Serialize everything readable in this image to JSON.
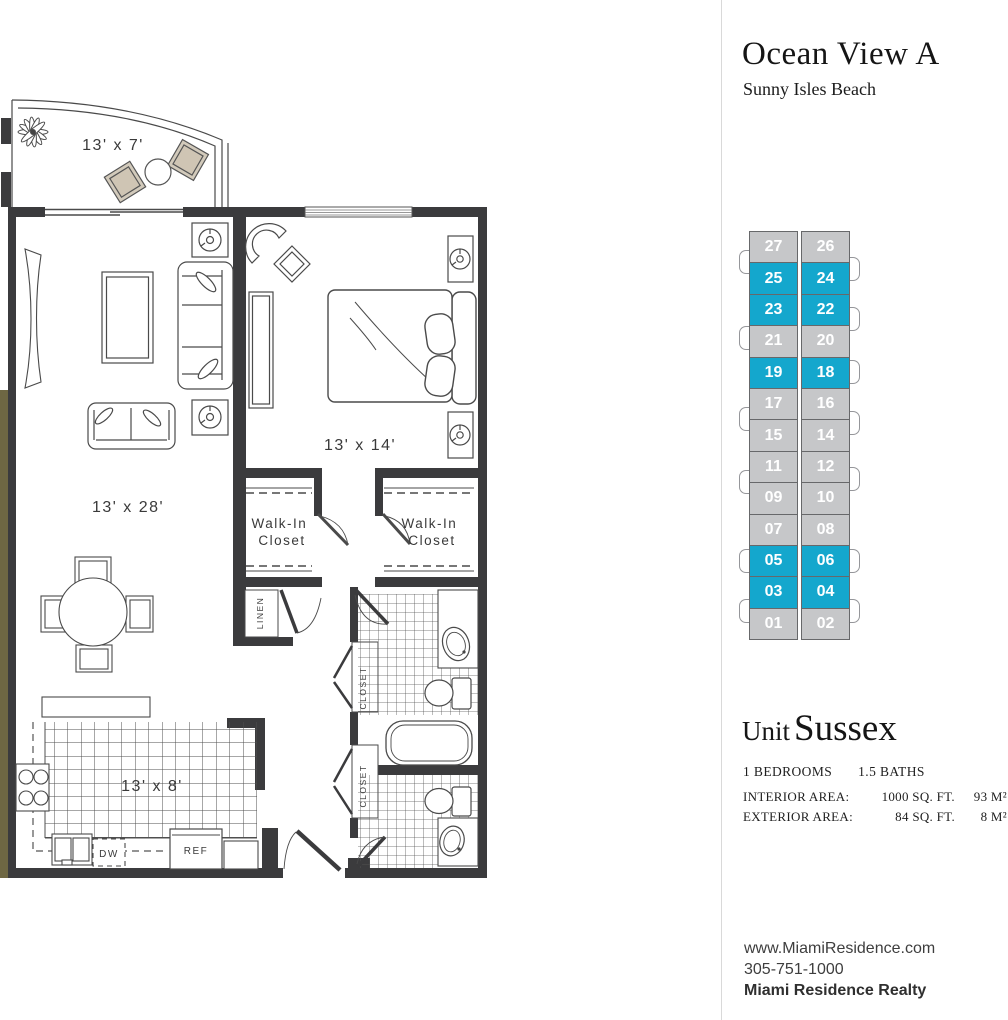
{
  "header": {
    "title": "Ocean View A",
    "subtitle": "Sunny Isles Beach"
  },
  "floor_plan": {
    "rooms": {
      "balcony": "13' x 7'",
      "bedroom": "13' x 14'",
      "living": "13' x 28'",
      "kitchen": "13' x 8'"
    },
    "labels": {
      "walk_in_line1": "Walk-In",
      "walk_in_line2": "Closet",
      "linen": "LINEN",
      "closet": "CLOSET",
      "dishwasher": "DW",
      "refrigerator": "REF"
    }
  },
  "floor_stack": {
    "selected_color": "#14a7cd",
    "default_color": "#c6c7c9",
    "rows": [
      {
        "left": "27",
        "right": "26",
        "selected": false
      },
      {
        "left": "25",
        "right": "24",
        "selected": true
      },
      {
        "left": "23",
        "right": "22",
        "selected": true
      },
      {
        "left": "21",
        "right": "20",
        "selected": false
      },
      {
        "left": "19",
        "right": "18",
        "selected": true
      },
      {
        "left": "17",
        "right": "16",
        "selected": false
      },
      {
        "left": "15",
        "right": "14",
        "selected": false
      },
      {
        "left": "11",
        "right": "12",
        "selected": false
      },
      {
        "left": "09",
        "right": "10",
        "selected": false
      },
      {
        "left": "07",
        "right": "08",
        "selected": false
      },
      {
        "left": "05",
        "right": "06",
        "selected": true
      },
      {
        "left": "03",
        "right": "04",
        "selected": true
      },
      {
        "left": "01",
        "right": "02",
        "selected": false
      }
    ]
  },
  "unit": {
    "label": "Unit",
    "name": "Sussex",
    "bedrooms": "1 BEDROOMS",
    "baths": "1.5 BATHS",
    "areas": [
      {
        "label": "INTERIOR AREA:",
        "sqft": "1000 SQ. FT.",
        "m2": "93 M²"
      },
      {
        "label": "EXTERIOR AREA:",
        "sqft": "84 SQ. FT.",
        "m2": "8 M²"
      }
    ]
  },
  "contact": {
    "website": "www.MiamiResidence.com",
    "phone": "305-751-1000",
    "company": "Miami Residence Realty"
  }
}
